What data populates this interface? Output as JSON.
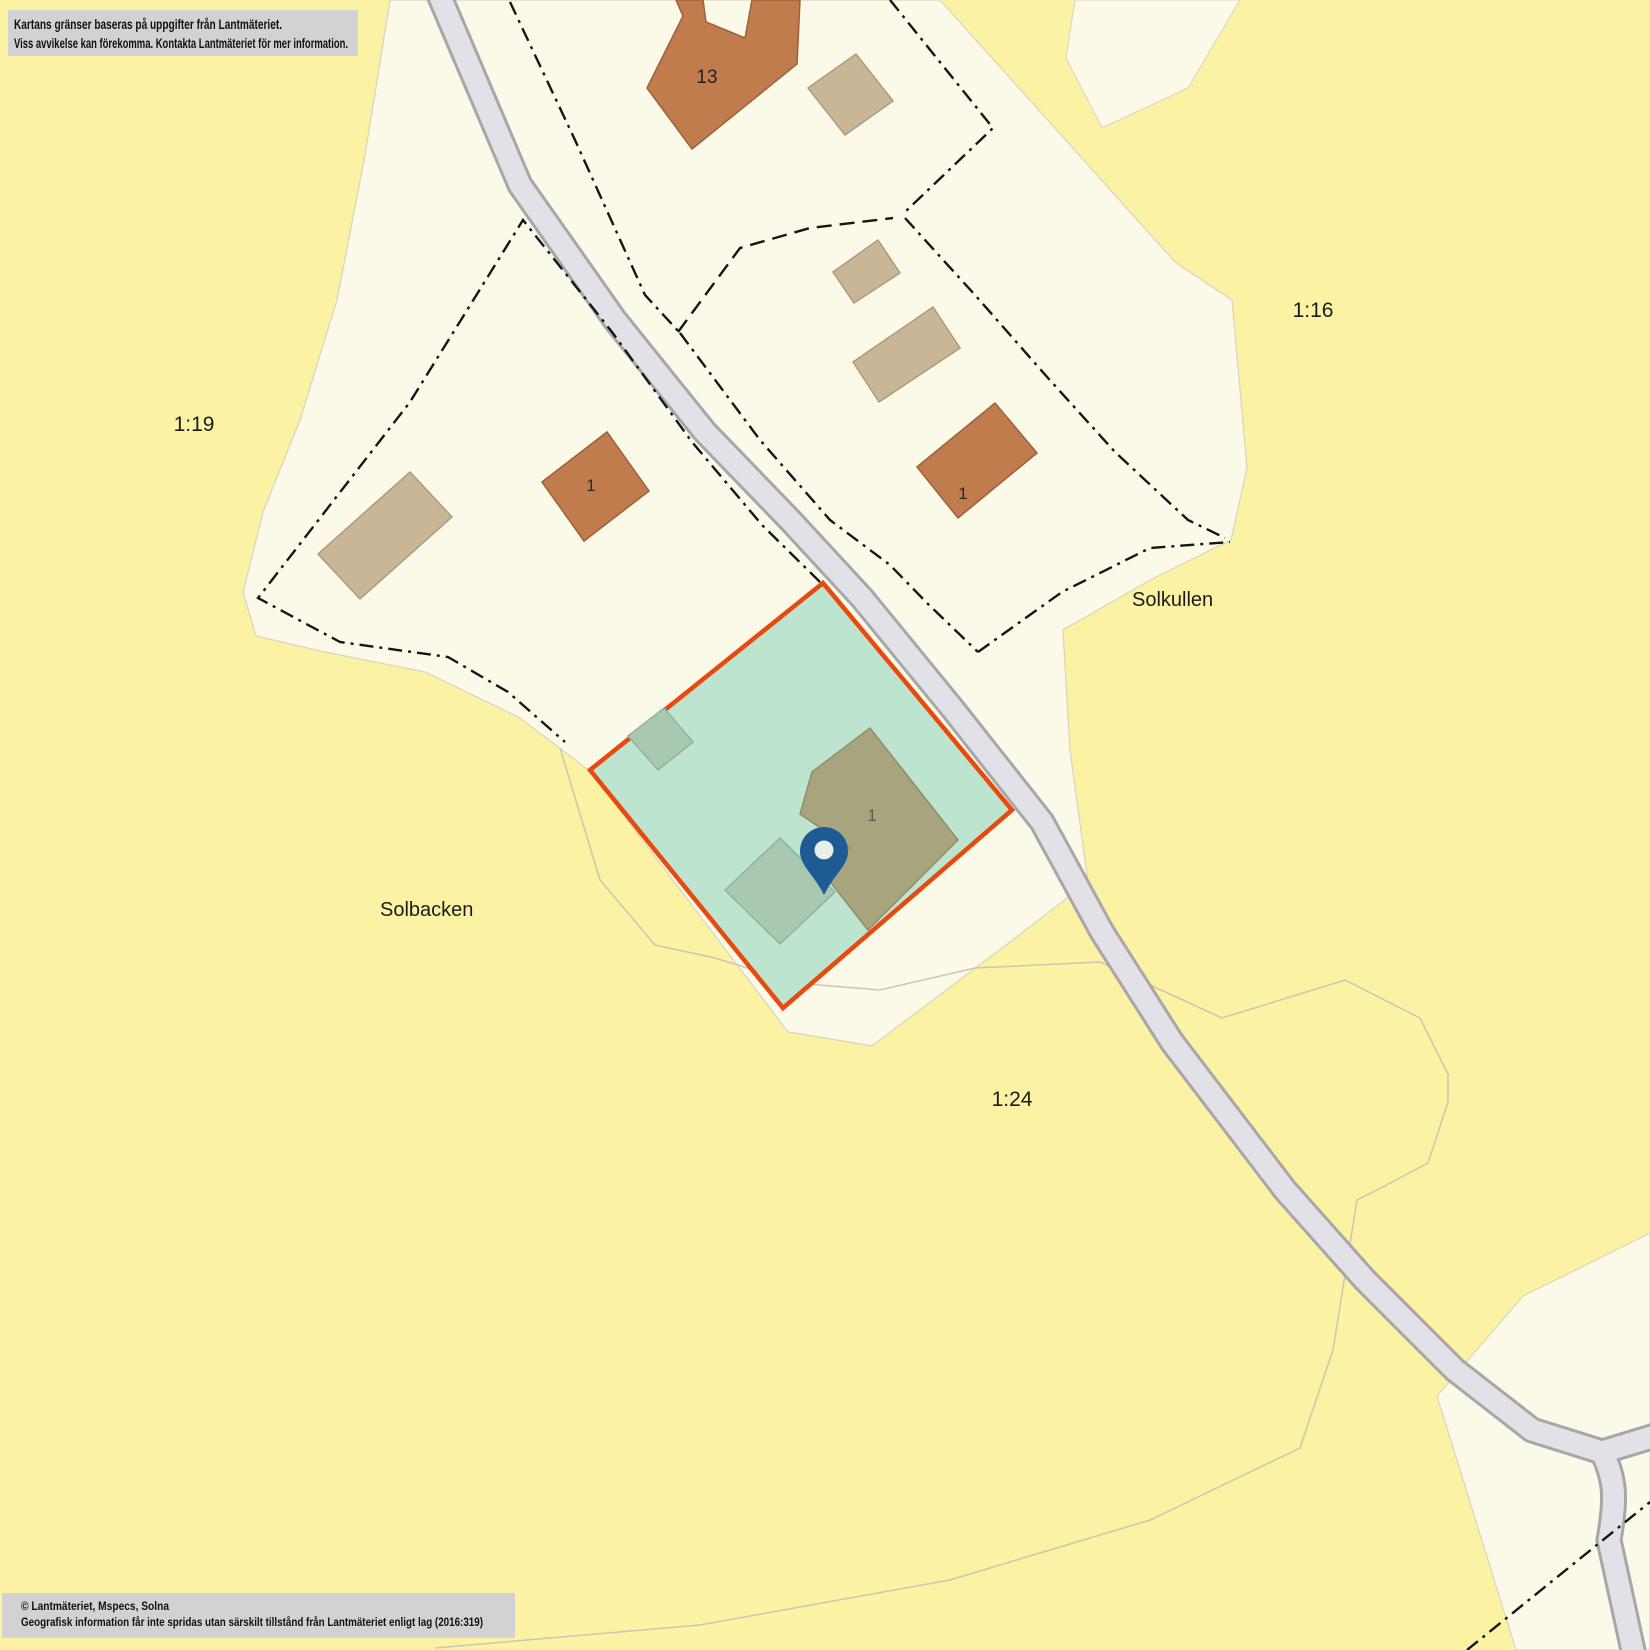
{
  "header_note": {
    "line1": "Kartans gränser baseras på uppgifter från Lantmäteriet.",
    "line2": "Viss avvikelse kan förekomma. Kontakta Lantmäteriet för mer information."
  },
  "footer_note": {
    "line1": "© Lantmäteriet, Mspecs, Solna",
    "line2": "Geografisk information får inte spridas utan särskilt tillstånd från Lantmäteriet enligt lag (2016:319)"
  },
  "labels": {
    "parcel_1_19": "1:19",
    "parcel_1_16": "1:16",
    "parcel_1_24": "1:24",
    "place_solkullen": "Solkullen",
    "place_solbacken": "Solbacken",
    "building_13": "13",
    "building_1_mid": "1",
    "building_1_right": "1",
    "building_1_highlight": "1"
  },
  "marker": {
    "name": "location-pin",
    "color": "#1E5A94"
  },
  "highlighted_property": {
    "fill": "#BCE4CF",
    "border": "#E8490F"
  },
  "colors": {
    "background_yellow": "#FBF3A3",
    "parcel_cream": "#FBF9E7",
    "road_fill": "#E1E1E7",
    "road_casing": "#A7A7A7",
    "building_orange": "#C17C4E",
    "building_tan": "#C9B696",
    "building_olive": "#A7A47E",
    "building_green_gray": "#A9C8B2",
    "boundary_line": "#151515",
    "note_box_gray": "#D2D2D2"
  }
}
